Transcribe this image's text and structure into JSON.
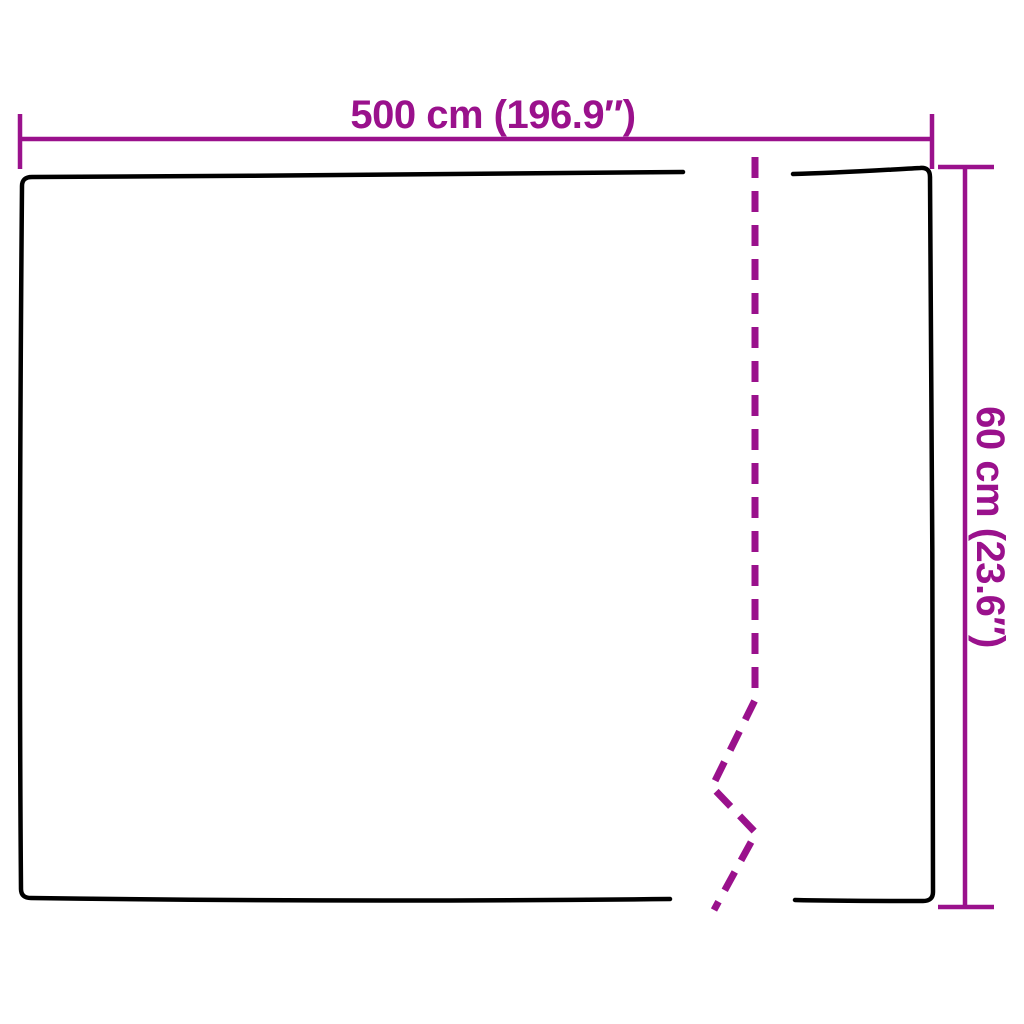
{
  "colors": {
    "dimension": "#9A118C",
    "outline": "#000000",
    "background": "#FFFFFF"
  },
  "diagram": {
    "type": "product-dimension-diagram",
    "width_dimension": {
      "label": "500 cm (196.9″)",
      "value_cm": 500,
      "value_inches": 196.9
    },
    "height_dimension": {
      "label": "60 cm (23.6″)",
      "value_cm": 60,
      "value_inches": 23.6
    }
  }
}
